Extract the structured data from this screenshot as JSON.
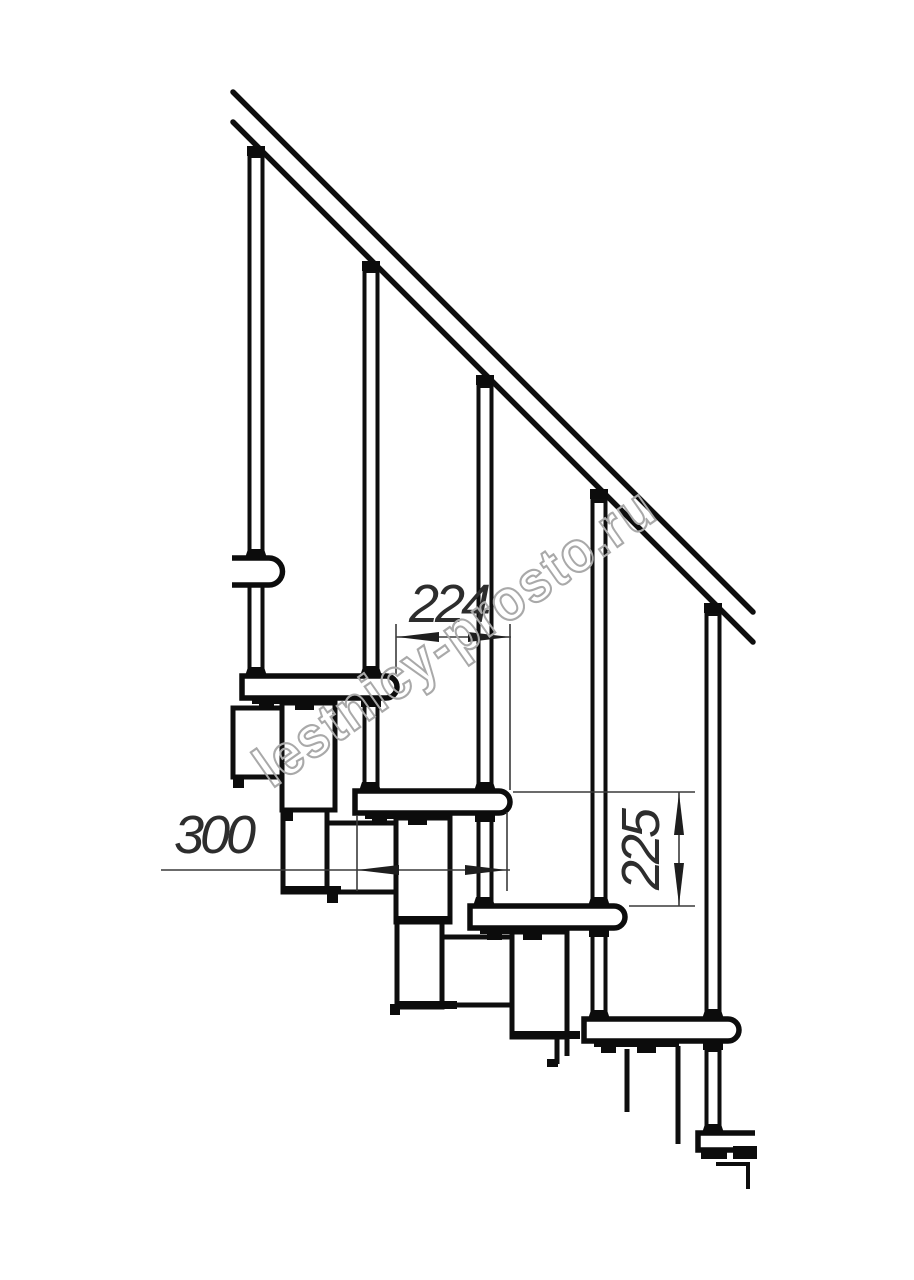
{
  "drawing": {
    "type": "modular-staircase-side-elevation",
    "watermark": "lestnicy-prosto.ru",
    "dimensions": {
      "step_run_mm": "224",
      "tread_length_mm": "300",
      "step_height_mm": "225"
    },
    "colors": {
      "line": "#0e0e0e",
      "dimension": "#3a3a3a",
      "watermark": "#a9a9a9",
      "background": "#ffffff"
    }
  }
}
